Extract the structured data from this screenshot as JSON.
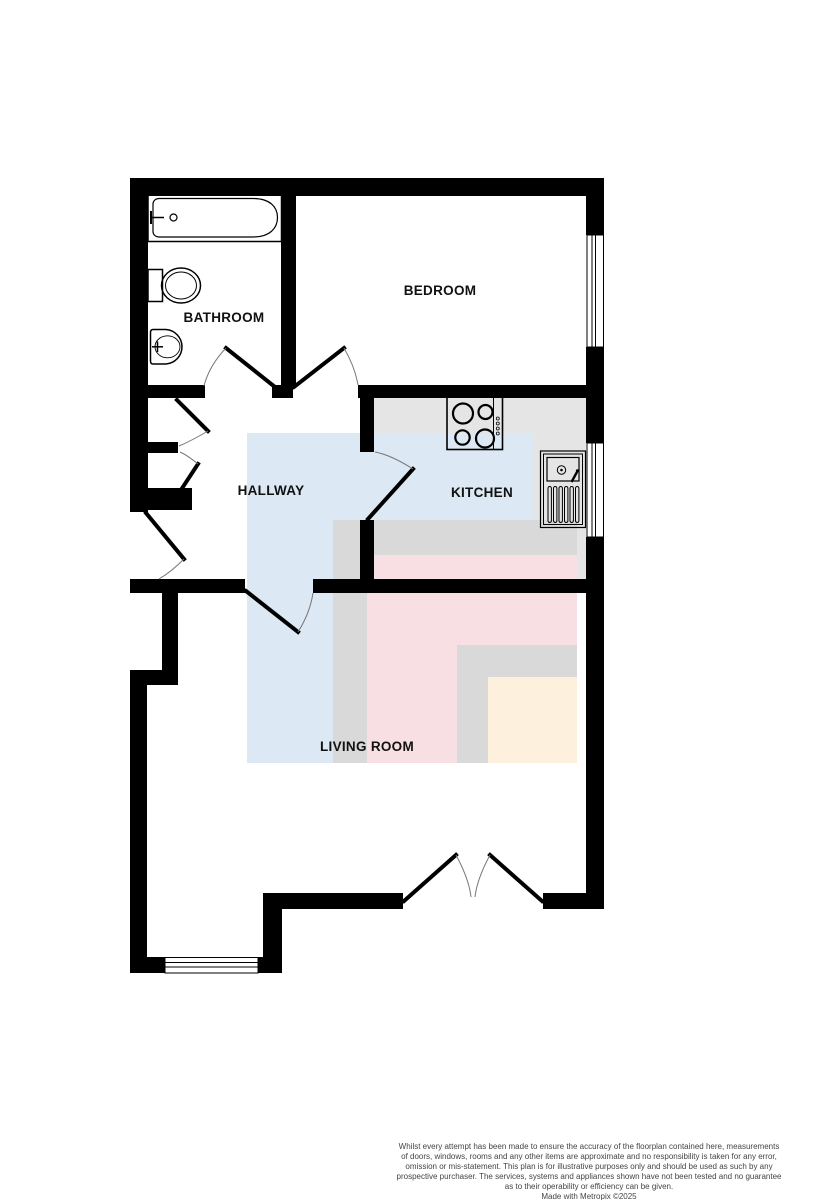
{
  "floorplan": {
    "labels": {
      "bathroom": "BATHROOM",
      "bedroom": "BEDROOM",
      "hallway": "HALLWAY",
      "kitchen": "KITCHEN",
      "living_room": "LIVING ROOM"
    },
    "colors": {
      "wall": "#000000",
      "kitchen_floor": "#e5e5e5",
      "overlay_blue": "#dce8f3",
      "overlay_gray": "#d9d9d9",
      "overlay_pink": "#f8dfe3",
      "overlay_yellow": "#fdf1de",
      "sink_basin": "#e9eef4"
    },
    "fixture_icons": [
      "bathtub-icon",
      "toilet-icon",
      "basin-icon",
      "hob-icon",
      "kitchen-sink-icon"
    ]
  },
  "footer": {
    "disclaimer_lines": [
      "Whilst every attempt has been made to ensure the accuracy of the floorplan contained here, measurements",
      "of doors, windows, rooms and any other items are approximate and no responsibility is taken for any error,",
      "omission or mis-statement. This plan is for illustrative purposes only and should be used as such by any",
      "prospective purchaser. The services, systems and appliances shown have not been tested and no guarantee",
      "as to their operability or efficiency can be given."
    ],
    "credit": "Made with Metropix ©2025"
  }
}
